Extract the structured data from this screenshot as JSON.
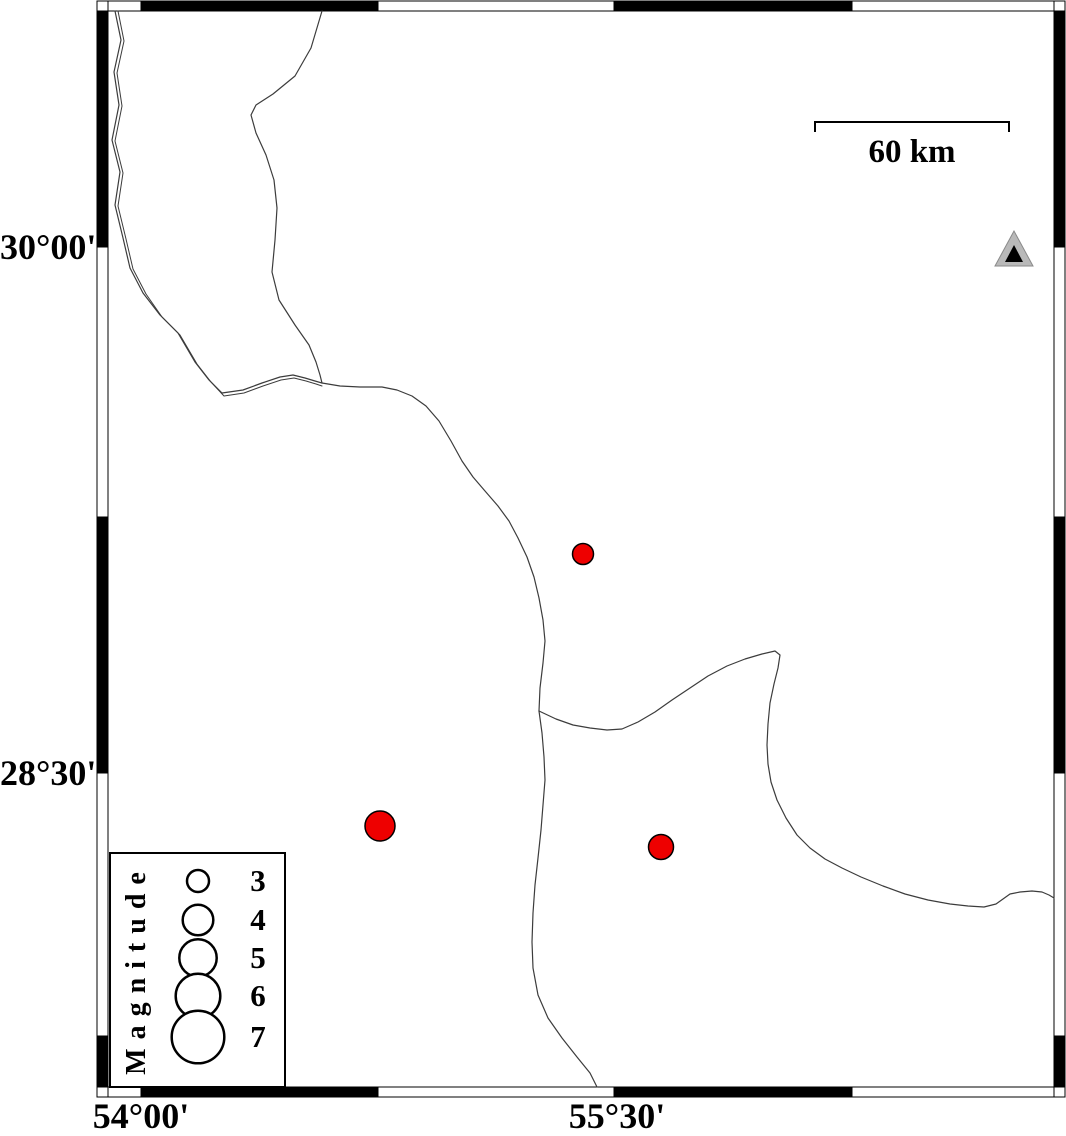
{
  "map": {
    "width": 1066,
    "height": 1136,
    "background": "#ffffff",
    "line_color": "#3c3c3c",
    "axis": {
      "lat_labels": [
        {
          "text": "30°00'",
          "y": 247
        },
        {
          "text": "28°30'",
          "y": 773
        }
      ],
      "lon_labels": [
        {
          "text": "54°00'",
          "x": 141
        },
        {
          "text": "55°30'",
          "x": 617
        }
      ]
    },
    "frame": {
      "outer": [
        97,
        1,
        1065,
        1097
      ],
      "inner": [
        108,
        11,
        1054,
        1087
      ],
      "top_segments": [
        {
          "a": 108,
          "b": 141,
          "f": "#ffffff"
        },
        {
          "a": 141,
          "b": 378,
          "f": "#000000"
        },
        {
          "a": 378,
          "b": 614,
          "f": "#ffffff"
        },
        {
          "a": 614,
          "b": 852,
          "f": "#000000"
        },
        {
          "a": 852,
          "b": 1054,
          "f": "#ffffff"
        }
      ],
      "bottom_segments": [
        {
          "a": 108,
          "b": 141,
          "f": "#ffffff"
        },
        {
          "a": 141,
          "b": 378,
          "f": "#000000"
        },
        {
          "a": 378,
          "b": 614,
          "f": "#ffffff"
        },
        {
          "a": 614,
          "b": 852,
          "f": "#000000"
        },
        {
          "a": 852,
          "b": 1054,
          "f": "#ffffff"
        }
      ],
      "left_segments": [
        {
          "a": 11,
          "b": 247,
          "f": "#000000"
        },
        {
          "a": 247,
          "b": 517,
          "f": "#ffffff"
        },
        {
          "a": 517,
          "b": 773,
          "f": "#000000"
        },
        {
          "a": 773,
          "b": 1036,
          "f": "#ffffff"
        },
        {
          "a": 1036,
          "b": 1087,
          "f": "#000000"
        }
      ],
      "right_segments": [
        {
          "a": 11,
          "b": 247,
          "f": "#000000"
        },
        {
          "a": 247,
          "b": 517,
          "f": "#ffffff"
        },
        {
          "a": 517,
          "b": 773,
          "f": "#000000"
        },
        {
          "a": 773,
          "b": 1036,
          "f": "#ffffff"
        },
        {
          "a": 1036,
          "b": 1087,
          "f": "#000000"
        }
      ]
    },
    "boundaries": [
      {
        "name": "boundary-northwest-strand-a",
        "w": 1.2,
        "points": [
          [
            115,
            11
          ],
          [
            121,
            40
          ],
          [
            114,
            72
          ],
          [
            119,
            105
          ],
          [
            112,
            140
          ],
          [
            120,
            172
          ],
          [
            115,
            205
          ],
          [
            123,
            238
          ],
          [
            130,
            268
          ],
          [
            143,
            293
          ],
          [
            160,
            315
          ],
          [
            178,
            333
          ],
          [
            195,
            362
          ],
          [
            209,
            380
          ],
          [
            222,
            393
          ],
          [
            243,
            390
          ],
          [
            262,
            383
          ],
          [
            280,
            377
          ],
          [
            293,
            375
          ],
          [
            305,
            378
          ],
          [
            315,
            381
          ],
          [
            322,
            383
          ]
        ]
      },
      {
        "name": "boundary-northwest-strand-b",
        "w": 1.0,
        "points": [
          [
            118,
            11
          ],
          [
            124,
            41
          ],
          [
            117,
            73
          ],
          [
            122,
            106
          ],
          [
            115,
            141
          ],
          [
            123,
            173
          ],
          [
            118,
            206
          ],
          [
            126,
            239
          ],
          [
            133,
            269
          ],
          [
            146,
            294
          ],
          [
            162,
            317
          ],
          [
            180,
            335
          ],
          [
            197,
            364
          ],
          [
            211,
            382
          ],
          [
            224,
            396
          ],
          [
            244,
            393
          ],
          [
            263,
            386
          ],
          [
            281,
            380
          ],
          [
            294,
            378
          ],
          [
            306,
            381
          ],
          [
            316,
            384
          ],
          [
            322,
            386
          ]
        ]
      },
      {
        "name": "boundary-north",
        "w": 1.2,
        "points": [
          [
            322,
            11
          ],
          [
            311,
            48
          ],
          [
            295,
            76
          ],
          [
            273,
            94
          ],
          [
            256,
            105
          ],
          [
            251,
            115
          ],
          [
            256,
            133
          ],
          [
            266,
            155
          ],
          [
            274,
            180
          ],
          [
            277,
            208
          ],
          [
            275,
            240
          ],
          [
            272,
            272
          ],
          [
            279,
            300
          ],
          [
            295,
            325
          ],
          [
            309,
            345
          ],
          [
            316,
            362
          ],
          [
            320,
            375
          ],
          [
            322,
            383
          ]
        ]
      },
      {
        "name": "boundary-central",
        "w": 1.2,
        "points": [
          [
            322,
            383
          ],
          [
            340,
            386
          ],
          [
            360,
            387
          ],
          [
            382,
            387
          ],
          [
            397,
            390
          ],
          [
            412,
            396
          ],
          [
            426,
            406
          ],
          [
            439,
            421
          ],
          [
            451,
            441
          ],
          [
            462,
            461
          ],
          [
            473,
            477
          ],
          [
            485,
            491
          ],
          [
            498,
            506
          ],
          [
            509,
            521
          ],
          [
            518,
            538
          ],
          [
            527,
            557
          ],
          [
            534,
            577
          ],
          [
            539,
            598
          ],
          [
            543,
            620
          ],
          [
            545,
            641
          ],
          [
            543,
            663
          ],
          [
            540,
            688
          ],
          [
            539,
            711
          ]
        ]
      },
      {
        "name": "boundary-south",
        "w": 1.2,
        "points": [
          [
            539,
            711
          ],
          [
            542,
            733
          ],
          [
            544,
            757
          ],
          [
            545,
            780
          ],
          [
            543,
            805
          ],
          [
            541,
            830
          ],
          [
            538,
            858
          ],
          [
            535,
            885
          ],
          [
            533,
            913
          ],
          [
            532,
            942
          ],
          [
            533,
            968
          ],
          [
            538,
            995
          ],
          [
            548,
            1018
          ],
          [
            562,
            1038
          ],
          [
            577,
            1057
          ],
          [
            590,
            1073
          ],
          [
            597,
            1087
          ]
        ]
      },
      {
        "name": "boundary-east",
        "w": 1.2,
        "points": [
          [
            539,
            711
          ],
          [
            556,
            719
          ],
          [
            573,
            725
          ],
          [
            590,
            728
          ],
          [
            607,
            730
          ],
          [
            622,
            729
          ],
          [
            638,
            722
          ],
          [
            655,
            712
          ],
          [
            672,
            700
          ],
          [
            690,
            688
          ],
          [
            708,
            676
          ],
          [
            727,
            666
          ],
          [
            745,
            659
          ],
          [
            762,
            654
          ],
          [
            775,
            651
          ],
          [
            780,
            655
          ],
          [
            778,
            668
          ],
          [
            774,
            684
          ],
          [
            770,
            703
          ],
          [
            768,
            724
          ],
          [
            767,
            745
          ],
          [
            768,
            764
          ],
          [
            771,
            782
          ],
          [
            777,
            800
          ],
          [
            786,
            818
          ],
          [
            797,
            835
          ],
          [
            810,
            848
          ],
          [
            825,
            859
          ],
          [
            842,
            868
          ],
          [
            861,
            877
          ],
          [
            883,
            886
          ],
          [
            905,
            894
          ],
          [
            928,
            900
          ],
          [
            950,
            904
          ],
          [
            968,
            906
          ],
          [
            984,
            907
          ],
          [
            996,
            904
          ],
          [
            1003,
            899
          ],
          [
            1010,
            894
          ],
          [
            1020,
            892
          ],
          [
            1032,
            891
          ],
          [
            1042,
            892
          ],
          [
            1049,
            895
          ],
          [
            1054,
            898
          ]
        ]
      }
    ],
    "earthquakes": {
      "fill": "#ee0000",
      "outline": "#000000",
      "points": [
        {
          "x": 583,
          "y": 554,
          "r": 10.5
        },
        {
          "x": 380,
          "y": 826,
          "r": 15
        },
        {
          "x": 661,
          "y": 847,
          "r": 12.5
        }
      ]
    },
    "station": {
      "fill": "#b9b9b9",
      "edge": "#8a8a8a",
      "inner_fill": "#000000",
      "outer": [
        [
          1014,
          231
        ],
        [
          995,
          266
        ],
        [
          1033,
          266
        ]
      ],
      "inner": [
        [
          1014,
          245
        ],
        [
          1005,
          262
        ],
        [
          1023,
          262
        ]
      ]
    },
    "scalebar": {
      "label": "60 km",
      "x1": 815,
      "x2": 1009,
      "y": 122,
      "tick_drop": 10
    }
  },
  "legend": {
    "title": "Magnitude",
    "box": [
      110,
      853,
      285,
      1087
    ],
    "circle_cx": 198,
    "label_x": 258,
    "entries": [
      {
        "label": "3",
        "cy": 881,
        "r": 11
      },
      {
        "label": "4",
        "cy": 920,
        "r": 15.3
      },
      {
        "label": "5",
        "cy": 958,
        "r": 18.7
      },
      {
        "label": "6",
        "cy": 996,
        "r": 22.3
      },
      {
        "label": "7",
        "cy": 1037,
        "r": 26.3
      }
    ]
  }
}
